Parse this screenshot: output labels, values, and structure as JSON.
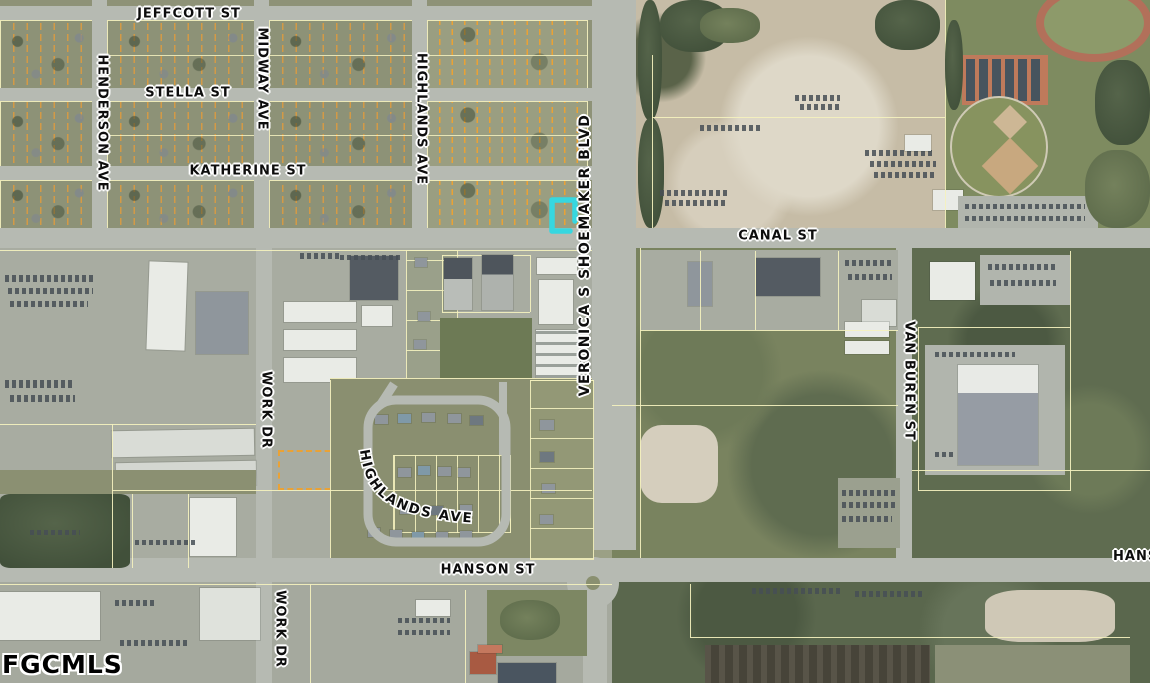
{
  "watermark": {
    "text": "FGCMLS"
  },
  "map": {
    "type": "aerial-parcel-map",
    "highlight": {
      "name": "subject-parcel",
      "color": "#36D7E0"
    },
    "colors": {
      "parcel_line": "#F2EFC0",
      "lot_line": "#E8A23C",
      "road": "#B6BAB2"
    },
    "street_labels": {
      "jeffcott": "JEFFCOTT ST",
      "henderson": "HENDERSON AVE",
      "stella": "STELLA ST",
      "midway": "MIDWAY AVE",
      "katherine": "KATHERINE ST",
      "highlands_north": "HIGHLANDS AVE",
      "shoemaker": "VERONICA S SHOEMAKER BLVD",
      "canal": "CANAL ST",
      "van_buren": "VAN BUREN ST",
      "work_dr_north": "WORK DR",
      "work_dr_south": "WORK DR",
      "highlands_loop": "HIGHLANDS AVE",
      "hanson": "HANSON ST",
      "hanson_east": "HANSON ST"
    }
  }
}
